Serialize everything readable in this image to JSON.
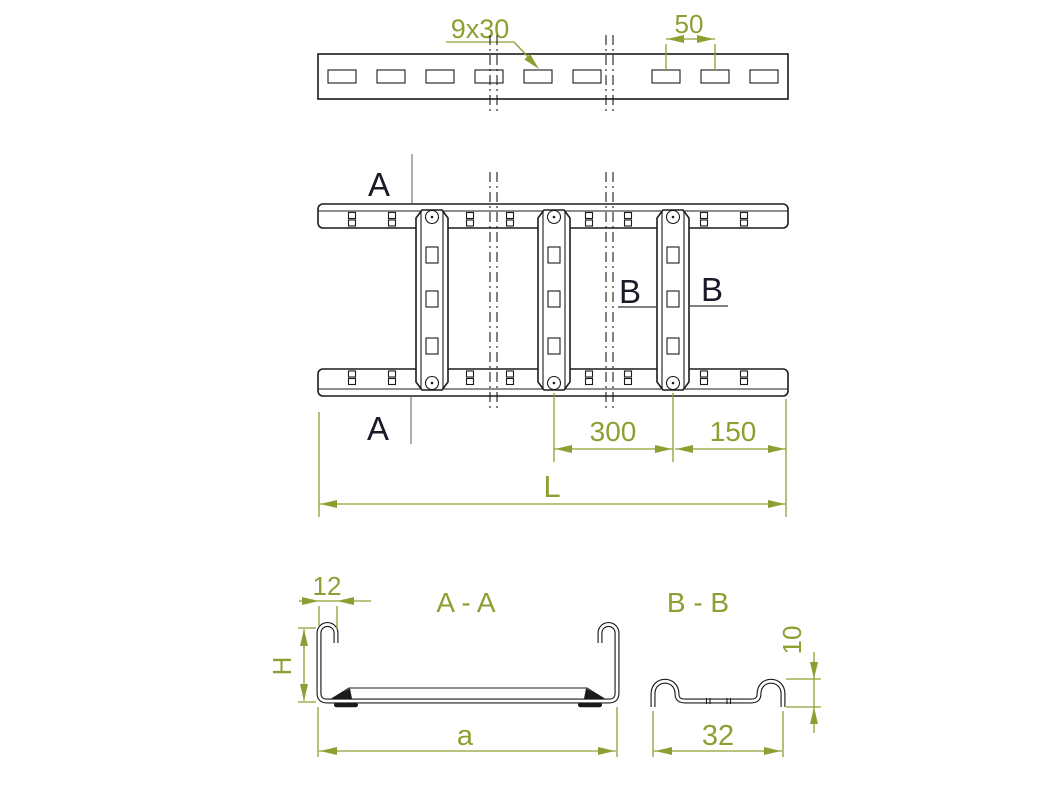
{
  "drawing_title": "Cable ladder dimensional drawing",
  "colors": {
    "dimension_accent": "#8f9e33",
    "drawing_line": "#1b1b1b",
    "section_label_text": "#1a1a28",
    "background": "#ffffff"
  },
  "top_view": {
    "slot_size_label": "9x30",
    "hole_pitch_label": "50"
  },
  "plan_view": {
    "section_a_label": "A",
    "section_b_label": "B",
    "rung_spacing_label": "300",
    "end_distance_label": "150",
    "total_length_label": "L"
  },
  "section_aa": {
    "title": "A - A",
    "flange_width_label": "12",
    "height_label": "H",
    "width_label": "a"
  },
  "section_bb": {
    "title": "B - B",
    "rung_height_label": "10",
    "rung_width_label": "32"
  }
}
